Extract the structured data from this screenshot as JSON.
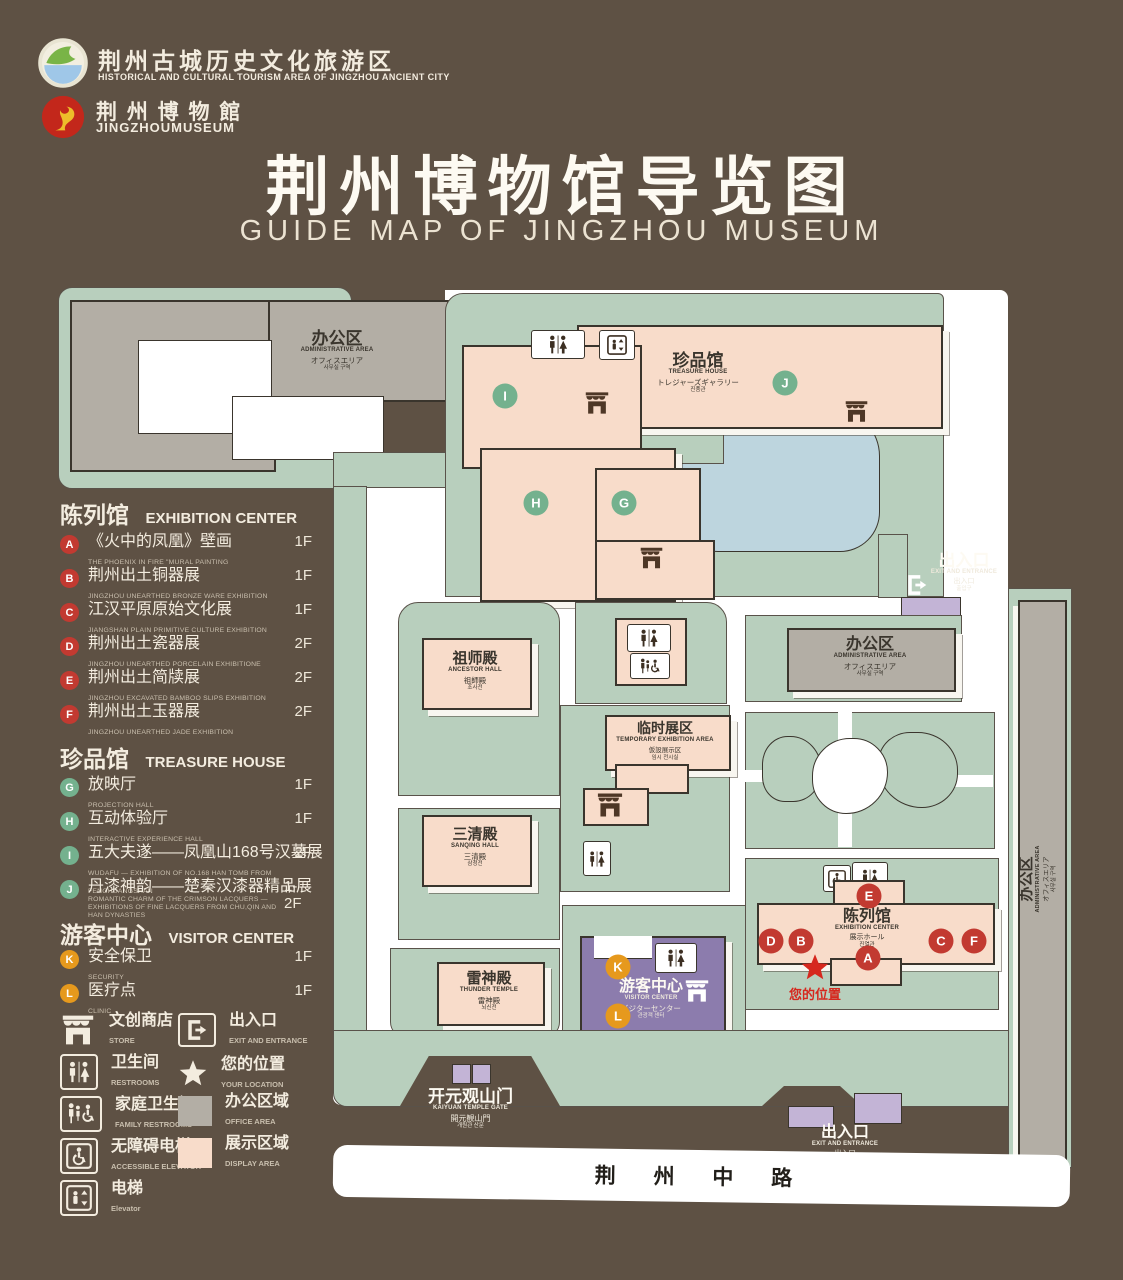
{
  "header": {
    "org_logo": {
      "zh": "荆州古城历史文化旅游区",
      "en": "HISTORICAL AND CULTURAL TOURISM AREA OF JINGZHOU ANCIENT CITY"
    },
    "museum_logo": {
      "zh": "荆 州 博 物 館",
      "en": "JINGZHOUMUSEUM"
    },
    "title_zh": "荆州博物馆导览图",
    "title_en": "GUIDE MAP OF JINGZHOU MUSEUM"
  },
  "legend": {
    "sections": [
      {
        "zh": "陈列馆",
        "en": "EXHIBITION CENTER",
        "items": [
          {
            "letter": "A",
            "zh": "《火中的凤凰》壁画",
            "en": "THE PHOENIX IN FIRE \"MURAL PAINTING",
            "floor": "1F"
          },
          {
            "letter": "B",
            "zh": "荆州出土铜器展",
            "en": "JINGZHOU UNEARTHED BRONZE WARE EXHIBITION",
            "floor": "1F"
          },
          {
            "letter": "C",
            "zh": "江汉平原原始文化展",
            "en": "JIANGSHAN PLAIN PRIMITIVE CULTURE EXHIBITION",
            "floor": "1F"
          },
          {
            "letter": "D",
            "zh": "荆州出土瓷器展",
            "en": "JINGZHOU UNEARTHED PORCELAIN EXHIBITIONE",
            "floor": "2F"
          },
          {
            "letter": "E",
            "zh": "荆州出土简牍展",
            "en": "JINGZHOU EXCAVATED BAMBOO SLIPS EXHIBITION",
            "floor": "2F"
          },
          {
            "letter": "F",
            "zh": "荆州出土玉器展",
            "en": "JINGZHOU UNEARTHED JADE EXHIBITION",
            "floor": "2F"
          }
        ]
      },
      {
        "zh": "珍品馆",
        "en": "TREASURE HOUSE",
        "items": [
          {
            "letter": "G",
            "zh": "放映厅",
            "en": "PROJECTION HALL",
            "floor": "1F"
          },
          {
            "letter": "H",
            "zh": "互动体验厅",
            "en": "INTERACTIVE EXPERIENCE HALL",
            "floor": "1F"
          },
          {
            "letter": "I",
            "zh": "五大夫遂——凤凰山168号汉墓展",
            "en": "WUDAFU — EXHIBITION OF NO.168 HAN TOMB FROM FENGHUANGSHAN",
            "floor": "2F"
          },
          {
            "letter": "J",
            "zh": "丹漆神韵——楚秦汉漆器精品展",
            "en": "ROMANTIC CHARM OF THE CRIMSON LACQUERS — EXHIBITIONS OF FINE LACQUERS FROM CHU,QIN AND HAN DYNASTIES",
            "floor": "1-2F"
          }
        ]
      },
      {
        "zh": "游客中心",
        "en": "VISITOR CENTER",
        "items": [
          {
            "letter": "K",
            "zh": "安全保卫",
            "en": "SECURITY",
            "floor": "1F"
          },
          {
            "letter": "L",
            "zh": "医疗点",
            "en": "CLINIC",
            "floor": "1F"
          }
        ]
      }
    ],
    "symbols": [
      {
        "icon": "store-icon",
        "zh": "文创商店",
        "en": "STORE"
      },
      {
        "icon": "exit-icon",
        "zh": "出入口",
        "en": "EXIT AND ENTRANCE"
      },
      {
        "icon": "restrooms-icon",
        "zh": "卫生间",
        "en": "RESTROOMS"
      },
      {
        "icon": "location-star-icon",
        "zh": "您的位置",
        "en": "YOUR LOCATION"
      },
      {
        "icon": "family-restroom-icon",
        "zh": "家庭卫生间",
        "en": "FAMILY RESTROOMS"
      },
      {
        "icon": "office-area-swatch",
        "zh": "办公区域",
        "en": "OFFICE AREA",
        "color": "#b3aea5"
      },
      {
        "icon": "accessible-elevator-icon",
        "zh": "无障碍电梯",
        "en": "ACCESSIBLE ELEVATOR"
      },
      {
        "icon": "display-area-swatch",
        "zh": "展示区域",
        "en": "DISPLAY AREA",
        "color": "#f8dcca"
      },
      {
        "icon": "elevator-icon",
        "zh": "电梯",
        "en": "Elevator"
      }
    ]
  },
  "map": {
    "buildings": {
      "admin": {
        "zh": "办公区",
        "en": "ADMINISTRATIVE AREA",
        "jp": "オフィスエリア",
        "kr": "사무실 구역"
      },
      "treasure_house": {
        "zh": "珍品馆",
        "en": "TREASURE HOUSE",
        "jp": "トレジャーズギャラリー",
        "kr": "진품관"
      },
      "ancestor_hall": {
        "zh": "祖师殿",
        "en": "ANCESTOR HALL",
        "jp": "祖師殿",
        "kr": "조사전"
      },
      "temporary_exhibition": {
        "zh": "临时展区",
        "en": "TEMPORARY EXHIBITION AREA",
        "jp": "仮設展示区",
        "kr": "임시 전시실"
      },
      "sanqing_hall": {
        "zh": "三清殿",
        "en": "SANQING HALL",
        "jp": "三清殿",
        "kr": "삼청전"
      },
      "thunder_temple": {
        "zh": "雷神殿",
        "en": "THUNDER TEMPLE",
        "jp": "雷神殿",
        "kr": "뇌신전"
      },
      "visitor_center": {
        "zh": "游客中心",
        "en": "VISITOR CENTER",
        "jp": "ビジターセンター",
        "kr": "관광객 센터"
      },
      "exhibition_center": {
        "zh": "陈列馆",
        "en": "EXHIBITION CENTER",
        "jp": "展示ホール",
        "kr": "진열관"
      }
    },
    "gates": {
      "exit_ne": {
        "zh": "出入口",
        "en": "EXIT AND ENTRANCE",
        "jp": "出入口",
        "kr": "출입구"
      },
      "exit_s": {
        "zh": "出入口",
        "en": "EXIT AND ENTRANCE",
        "jp": "出入口",
        "kr": "출입구"
      },
      "kaiyuan_gate": {
        "zh": "开元观山门",
        "en": "KAIYUAN TEMPLE GATE",
        "jp": "開元観山門",
        "kr": "개원관 산문"
      }
    },
    "your_location": "您的位置",
    "road": "荆 州 中 路",
    "markers": [
      {
        "letter": "I"
      },
      {
        "letter": "J"
      },
      {
        "letter": "H"
      },
      {
        "letter": "G"
      },
      {
        "letter": "E"
      },
      {
        "letter": "D"
      },
      {
        "letter": "B"
      },
      {
        "letter": "C"
      },
      {
        "letter": "F"
      },
      {
        "letter": "A"
      },
      {
        "letter": "K"
      },
      {
        "letter": "L"
      }
    ]
  },
  "colors": {
    "background": "#5e5144",
    "map_green": "#b8cfbd",
    "building_pink": "#f8dcca",
    "office_gray": "#b3aea5",
    "visitor_purple": "#8c7cad",
    "gate_purple": "#c3b4d6",
    "pond_blue": "#bdd5de",
    "badge_red": "#c23a31",
    "badge_green": "#74b18e",
    "badge_orange": "#e6991d",
    "star_red": "#d6281e"
  }
}
